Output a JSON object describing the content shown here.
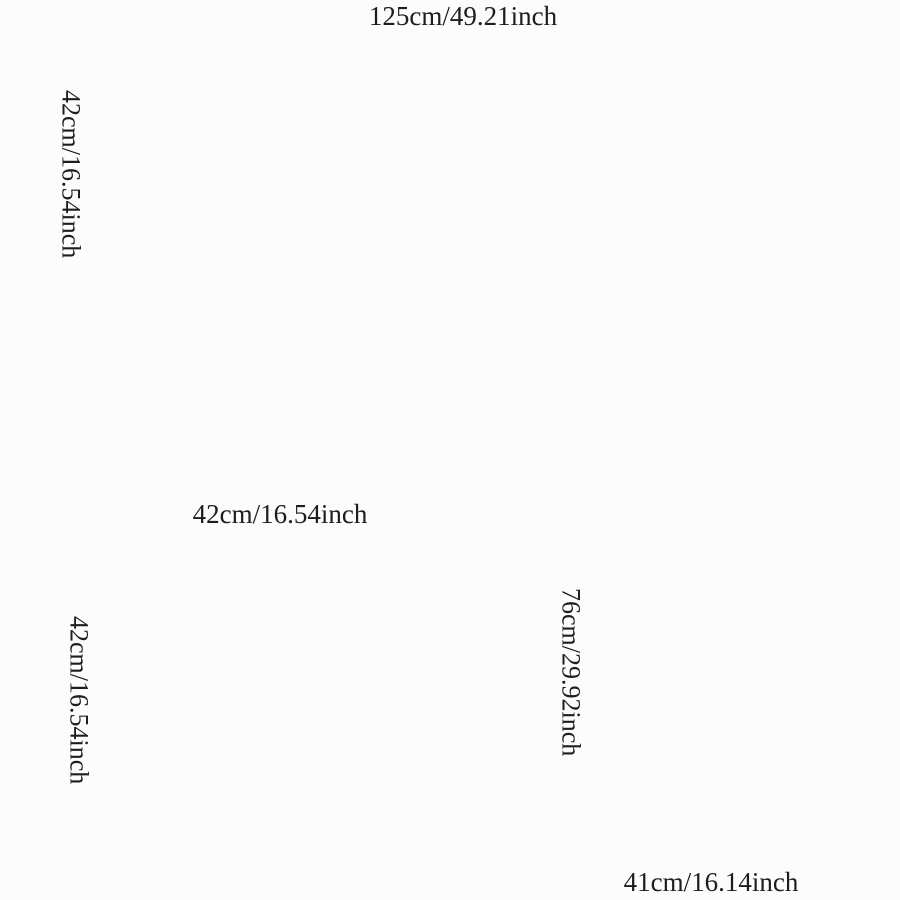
{
  "page": {
    "background_color": "#fcfcfc",
    "title": "Car floor mat dimension diagram"
  },
  "diagram": {
    "colors": {
      "mat_rim": "#8a3931",
      "mat_rim_dark": "#5c1f19",
      "mat_base": "#1e0e0c",
      "bead_red": "#9a2e27",
      "bead_highlight": "#c1564d",
      "white_dot": "#efe9dc",
      "dimension_line": "#1e1e1e",
      "label_text": "#1d1d1d"
    },
    "figures": {
      "rear_mat_set": {
        "name": "Three linked octagonal mats",
        "width_label": "125cm/49.21inch",
        "height_label": "42cm/16.54inch"
      },
      "square_mat": {
        "name": "Square octagonal mat",
        "width_label": "42cm/16.54inch",
        "height_label": "42cm/16.54inch"
      },
      "driver_mat": {
        "name": "Bottle-shaped driver mat",
        "height_label": "76cm/29.92inch",
        "width_label": "41cm/16.14inch"
      }
    }
  }
}
